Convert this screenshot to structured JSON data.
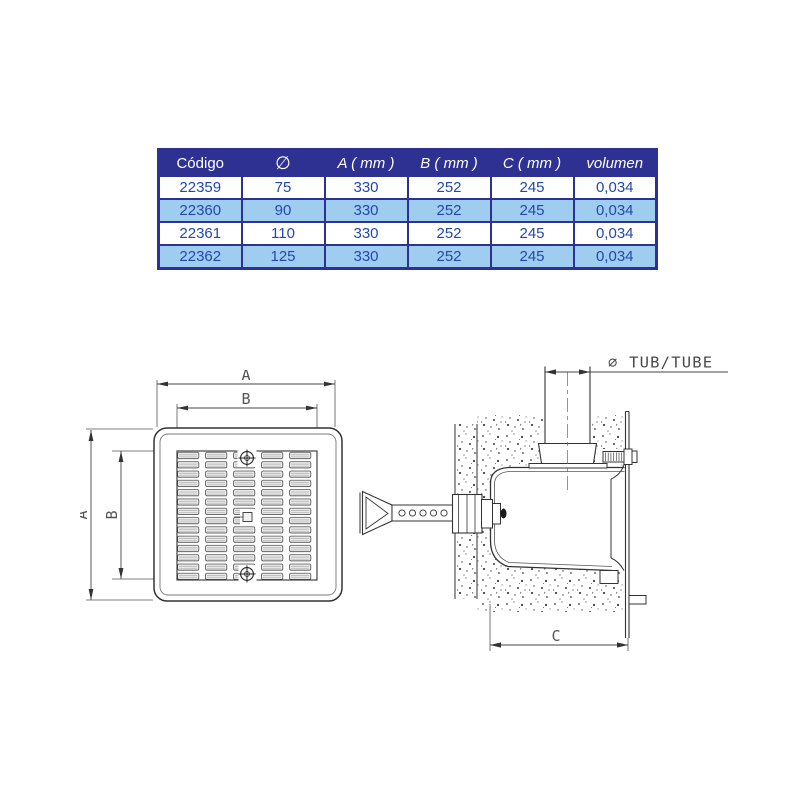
{
  "colors": {
    "table_border": "#2e3192",
    "header_bg": "#2e3192",
    "header_text": "#ffffff",
    "cell_text": "#2447ae",
    "row_alt_bg": "#9fcdf0",
    "row_bg": "#ffffff",
    "drawing_line": "#333333"
  },
  "table": {
    "headers": [
      "Código",
      "∅",
      "A ( mm )",
      "B ( mm )",
      "C ( mm )",
      "volumen"
    ],
    "rows": [
      [
        "22359",
        "75",
        "330",
        "252",
        "245",
        "0,034"
      ],
      [
        "22360",
        "90",
        "330",
        "252",
        "245",
        "0,034"
      ],
      [
        "22361",
        "110",
        "330",
        "252",
        "245",
        "0,034"
      ],
      [
        "22362",
        "125",
        "330",
        "252",
        "245",
        "0,034"
      ]
    ]
  },
  "front_view": {
    "dim_a_top": "A",
    "dim_b_top": "B",
    "dim_a_left": "A",
    "dim_b_left": "B"
  },
  "side_view": {
    "tube_label": "∅ TUB/TUBE",
    "dim_c": "C"
  }
}
